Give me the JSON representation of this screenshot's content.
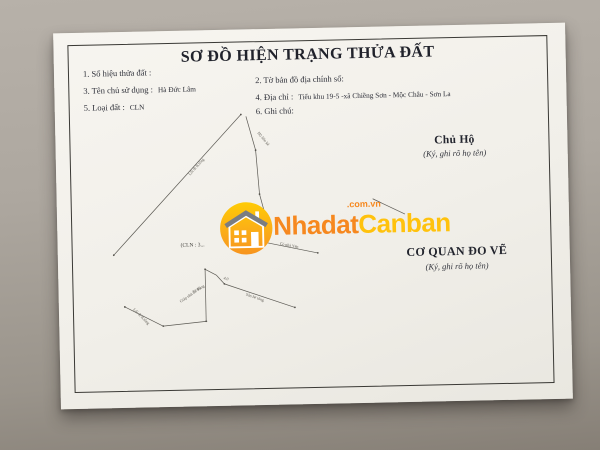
{
  "document": {
    "title": "SƠ ĐỒ HIỆN TRẠNG THỬA ĐẤT",
    "fields_left": [
      {
        "label": "1. Số hiệu thửa đất :",
        "value": ""
      },
      {
        "label": "3. Tên chủ sử dụng :",
        "value": "Hà Đức Lâm"
      },
      {
        "label": "5. Loại đất :",
        "value": "CLN"
      }
    ],
    "fields_right": [
      {
        "label": "2. Tờ bản đồ địa chính số:",
        "value": ""
      },
      {
        "label": "4. Địa chỉ :",
        "value": "Tiểu khu 19-5 -xã Chiềng Sơn - Mộc Châu - Sơn La"
      },
      {
        "label": "6. Ghi chú:",
        "value": ""
      }
    ],
    "signatures": [
      {
        "title": "Chủ Hộ",
        "note": "(Ký, ghi rõ họ tên)"
      },
      {
        "title": "CƠ QUAN ĐO VẼ",
        "note": "(Ký, ghi rõ họ tên)"
      }
    ],
    "diagram": {
      "parcel_label": {
        "text": "(CLN : 3...",
        "x": 108,
        "y": 203
      },
      "lines": [
        [
          41,
          210,
          171,
          72
        ],
        [
          176,
          74,
          185,
          108
        ],
        [
          185,
          108,
          188,
          152
        ],
        [
          188,
          152,
          197,
          188
        ],
        [
          197,
          188,
          191,
          200
        ],
        [
          191,
          200,
          245,
          212
        ],
        [
          151,
          241,
          221,
          266
        ],
        [
          132,
          226,
          132,
          278
        ],
        [
          89,
          282,
          133,
          278
        ],
        [
          51,
          262,
          89,
          282
        ],
        [
          132,
          226,
          143,
          232
        ],
        [
          143,
          232,
          151,
          241
        ],
        [
          301,
          159,
          333,
          175
        ]
      ],
      "vertices": [
        [
          41,
          210
        ],
        [
          171,
          72
        ],
        [
          185,
          108
        ],
        [
          188,
          152
        ],
        [
          191,
          200
        ],
        [
          245,
          212
        ],
        [
          151,
          241
        ],
        [
          221,
          266
        ],
        [
          132,
          226
        ],
        [
          132,
          278
        ],
        [
          89,
          282
        ],
        [
          51,
          262
        ]
      ],
      "annotations": [
        {
          "text": "Lối đi B.tông",
          "x": 119,
          "y": 132,
          "rot": -47
        },
        {
          "text": "Hộ liền kề",
          "x": 187,
          "y": 91,
          "rot": 52
        },
        {
          "text": "Có nhà Yến",
          "x": 207,
          "y": 203,
          "rot": 12
        },
        {
          "text": "Lối đi B.tông",
          "x": 59,
          "y": 265,
          "rot": 46
        },
        {
          "text": "Giáp nhà Ô. Tùng",
          "x": 107,
          "y": 259,
          "rot": -33
        },
        {
          "text": "Sân bê tông",
          "x": 172,
          "y": 253,
          "rot": 20
        },
        {
          "text": "14.46",
          "x": 120,
          "y": 250,
          "rot": -33
        },
        {
          "text": "4.0",
          "x": 150,
          "y": 236,
          "rot": 20
        }
      ]
    }
  },
  "watermark": {
    "brand_part1": "Nhadat",
    "brand_part2": "Canban",
    "suffix": ".com.vn",
    "colors": {
      "orange": "#F6881F",
      "yellow": "#FFC20D",
      "circle_top": "#FFCB05",
      "circle_mid": "#FBAD18",
      "circle_bottom": "#F7941E"
    }
  }
}
